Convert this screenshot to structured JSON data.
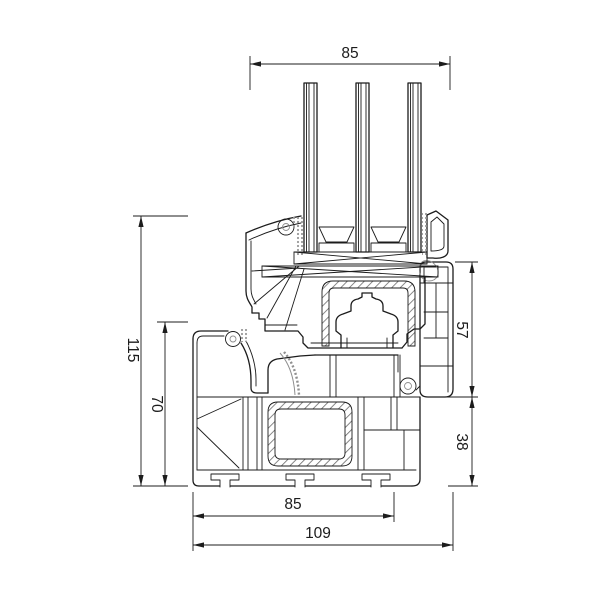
{
  "drawing": {
    "type": "technical-cross-section",
    "subject": "PVC window profile section with triple glazing",
    "units": "mm",
    "line_color": "#1c1c1c",
    "gasket_color": "#8f8f8f",
    "background": "#ffffff",
    "dimensions": {
      "top_sash_width": "85",
      "left_total_height": "115",
      "left_frame_height": "70",
      "right_upper_height": "57",
      "right_lower_height": "38",
      "bottom_frame_width": "85",
      "bottom_total_width": "109"
    }
  }
}
